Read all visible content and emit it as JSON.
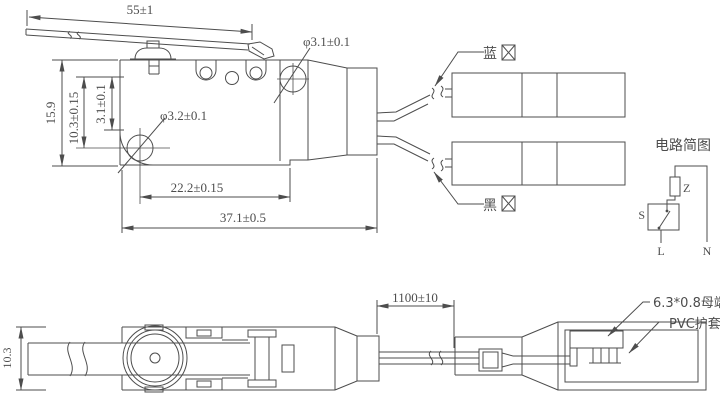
{
  "main_view": {
    "lever_length": "55±1",
    "top_hole_dia": "φ3.1±0.1",
    "mount_hole_dia": "φ3.2±0.1",
    "body_height": "15.9",
    "hole_center_height": "10.3±0.15",
    "hole_offset": "3.1±0.1",
    "hole_to_body_end": "22.2±0.15",
    "total_length": "37.1±0.5"
  },
  "wires": {
    "blue_label": "蓝",
    "black_label": "黑"
  },
  "circuit_diagram": {
    "title": "电路简图",
    "load_label": "Z",
    "switch_label": "S",
    "line_terminal": "L",
    "neutral_terminal": "N"
  },
  "bottom_view": {
    "lever_width": "10.3",
    "cable_length": "1100±10",
    "terminal_spec": "6.3*0.8母端",
    "sleeve_label": "PVC护套"
  },
  "colors": {
    "line": "#4d4d4d",
    "background": "#ffffff"
  }
}
